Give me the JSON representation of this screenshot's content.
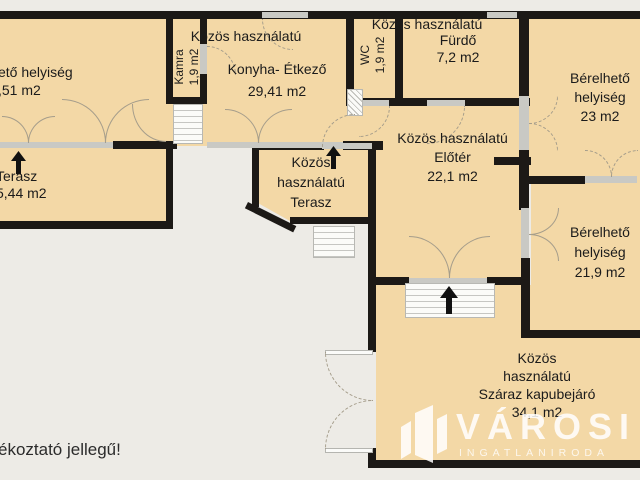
{
  "disclaimer": "ékoztató jellegű!",
  "watermark": {
    "name": "VÁROSI",
    "subtitle": "INGATLANIRODA"
  },
  "colors": {
    "room_fill": "#f3d8a6",
    "wall": "#1c1916",
    "background": "#edebe6",
    "window": "#c9c9c4",
    "watermark": "#ffffff"
  },
  "rooms": {
    "left_room": {
      "line1": "ető helyiség",
      "line2": ",51 m2"
    },
    "kamra": {
      "line1": "Kamra",
      "line2": "1,9 m2"
    },
    "kitchen": {
      "line1": "Közös használatú",
      "line2": "Konyha- Étkező",
      "line3": "29,41 m2"
    },
    "wc": {
      "line1": "WC",
      "line2": "1,9 m2"
    },
    "bathroom": {
      "line1": "Közös használatú",
      "line2": "Fürdő",
      "line3": "7,2 m2"
    },
    "rentable_top": {
      "line1": "Bérelhető",
      "line2": "helyiség",
      "line3": "23 m2"
    },
    "hall": {
      "line1": "Közös használatú",
      "line2": "Előtér",
      "line3": "22,1 m2"
    },
    "terrace_left": {
      "line1": "Terasz",
      "line2": "5,44 m2"
    },
    "terrace_center": {
      "line1": "Közös",
      "line2": "használatú",
      "line3": "Terasz"
    },
    "rentable_right": {
      "line1": "Bérelhető",
      "line2": "helyiség",
      "line3": "21,9 m2"
    },
    "gateway": {
      "line1": "Közös",
      "line2": "használatú",
      "line3": "Száraz kapubejáró",
      "line4": "34,1 m2"
    }
  }
}
